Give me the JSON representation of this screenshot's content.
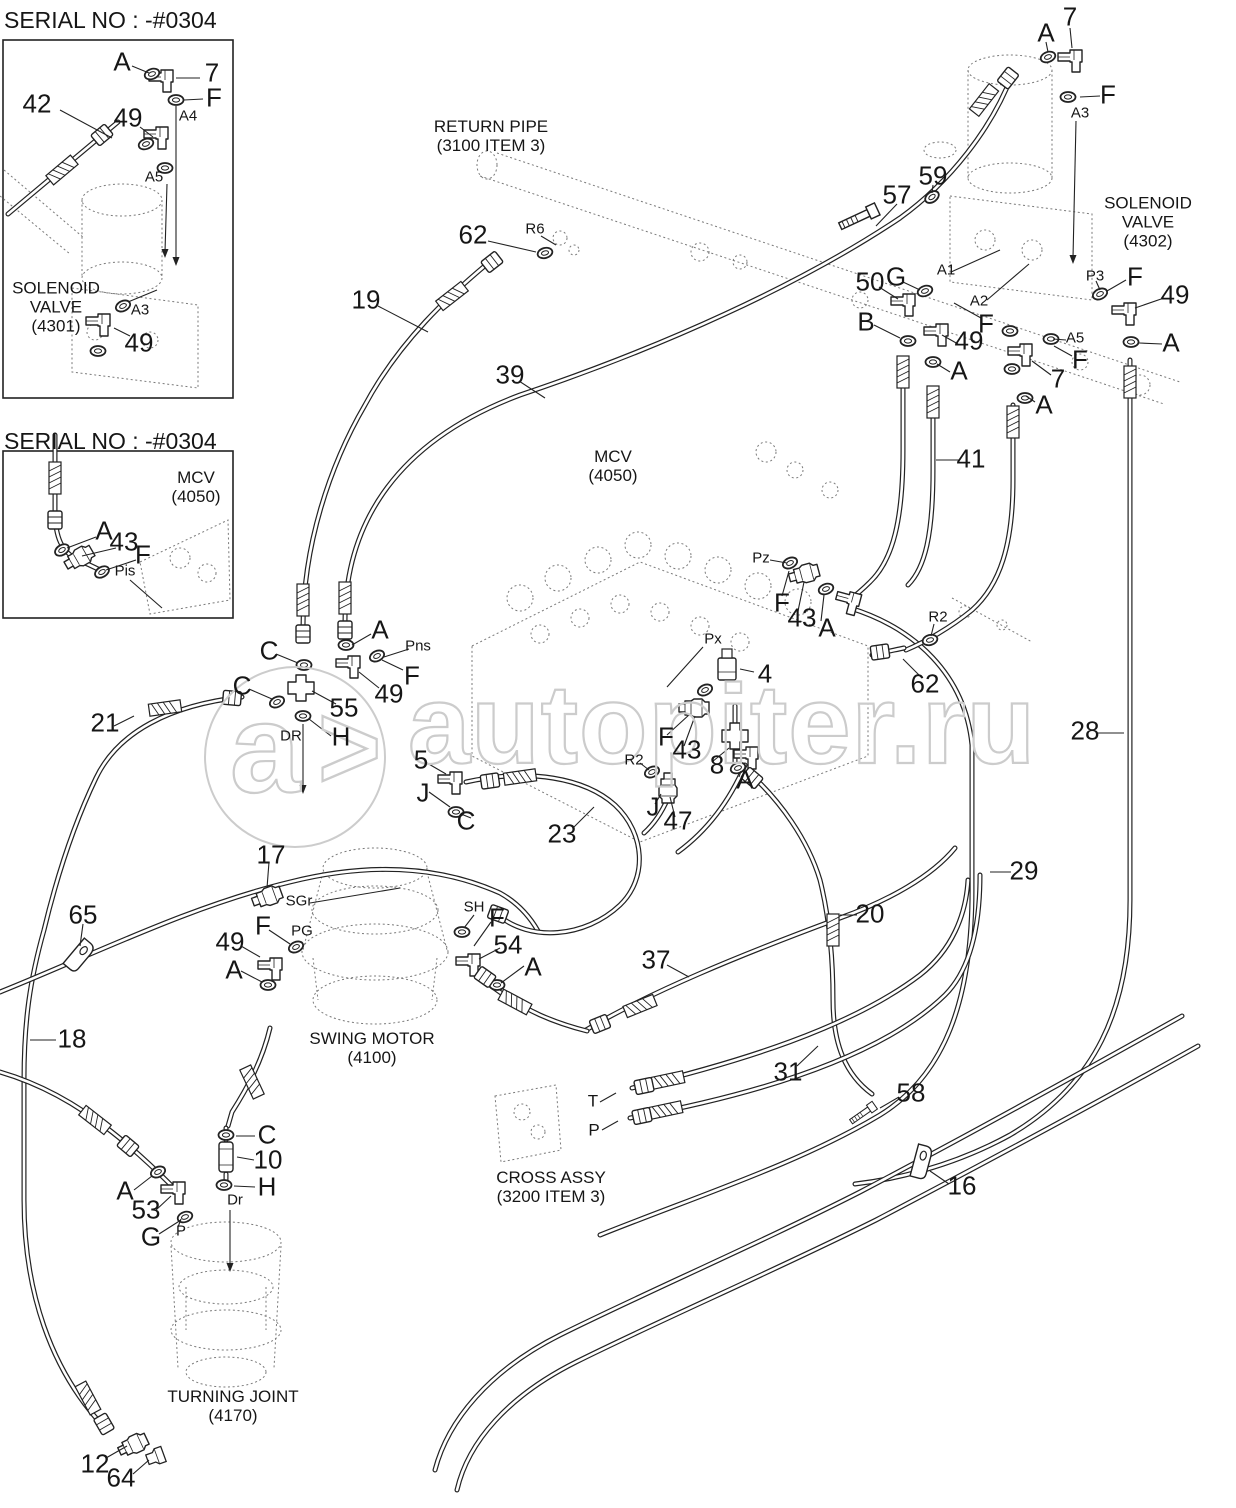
{
  "page": {
    "background": "#ffffff",
    "line_color": "#222222",
    "watermark_color": "#cccccc"
  },
  "watermark": {
    "text": "autopiter.ru",
    "logo_letter": "a",
    "logo_arrow": ">"
  },
  "diagram": {
    "labels": [
      {
        "t": "SERIAL NO : -#0304",
        "x": 4,
        "y": 8,
        "k": "t"
      },
      {
        "t": "A",
        "x": 122,
        "y": 62,
        "k": "l"
      },
      {
        "t": "7",
        "x": 212,
        "y": 73,
        "k": "n"
      },
      {
        "t": "F",
        "x": 214,
        "y": 98,
        "k": "l"
      },
      {
        "t": "A4",
        "x": 188,
        "y": 117,
        "k": "p"
      },
      {
        "t": "42",
        "x": 37,
        "y": 104,
        "k": "n"
      },
      {
        "t": "49",
        "x": 128,
        "y": 118,
        "k": "n"
      },
      {
        "t": "A5",
        "x": 154,
        "y": 178,
        "k": "p"
      },
      {
        "t": "SOLENOID\nVALVE\n(4301)",
        "x": 56,
        "y": 307,
        "k": "c"
      },
      {
        "t": "A3",
        "x": 140,
        "y": 311,
        "k": "p"
      },
      {
        "t": "49",
        "x": 139,
        "y": 343,
        "k": "n"
      },
      {
        "t": "SERIAL NO : -#0304",
        "x": 4,
        "y": 429,
        "k": "t"
      },
      {
        "t": "MCV\n(4050)",
        "x": 196,
        "y": 487,
        "k": "c"
      },
      {
        "t": "A",
        "x": 104,
        "y": 531,
        "k": "l"
      },
      {
        "t": "43",
        "x": 124,
        "y": 542,
        "k": "n"
      },
      {
        "t": "F",
        "x": 143,
        "y": 555,
        "k": "l"
      },
      {
        "t": "Pis",
        "x": 125,
        "y": 572,
        "k": "p"
      },
      {
        "t": "RETURN PIPE\n(3100 ITEM 3)",
        "x": 491,
        "y": 136,
        "k": "c"
      },
      {
        "t": "62",
        "x": 473,
        "y": 235,
        "k": "n"
      },
      {
        "t": "R6",
        "x": 535,
        "y": 230,
        "k": "p"
      },
      {
        "t": "19",
        "x": 366,
        "y": 300,
        "k": "n"
      },
      {
        "t": "39",
        "x": 510,
        "y": 375,
        "k": "n"
      },
      {
        "t": "A",
        "x": 1046,
        "y": 33,
        "k": "l"
      },
      {
        "t": "7",
        "x": 1070,
        "y": 17,
        "k": "n"
      },
      {
        "t": "F",
        "x": 1108,
        "y": 95,
        "k": "l"
      },
      {
        "t": "A3",
        "x": 1080,
        "y": 114,
        "k": "p"
      },
      {
        "t": "SOLENOID VALVE\n(4302)",
        "x": 1148,
        "y": 222,
        "k": "c"
      },
      {
        "t": "57",
        "x": 897,
        "y": 195,
        "k": "n"
      },
      {
        "t": "59",
        "x": 933,
        "y": 176,
        "k": "n"
      },
      {
        "t": "50",
        "x": 870,
        "y": 282,
        "k": "n"
      },
      {
        "t": "G",
        "x": 896,
        "y": 277,
        "k": "l"
      },
      {
        "t": "A1",
        "x": 946,
        "y": 271,
        "k": "p"
      },
      {
        "t": "A2",
        "x": 979,
        "y": 302,
        "k": "p"
      },
      {
        "t": "F",
        "x": 986,
        "y": 324,
        "k": "l"
      },
      {
        "t": "B",
        "x": 866,
        "y": 322,
        "k": "l"
      },
      {
        "t": "49",
        "x": 969,
        "y": 341,
        "k": "n"
      },
      {
        "t": "A",
        "x": 959,
        "y": 371,
        "k": "l"
      },
      {
        "t": "P3",
        "x": 1095,
        "y": 277,
        "k": "p"
      },
      {
        "t": "F",
        "x": 1135,
        "y": 277,
        "k": "l"
      },
      {
        "t": "49",
        "x": 1175,
        "y": 295,
        "k": "n"
      },
      {
        "t": "A",
        "x": 1171,
        "y": 343,
        "k": "l"
      },
      {
        "t": "A5",
        "x": 1075,
        "y": 339,
        "k": "p"
      },
      {
        "t": "F",
        "x": 1080,
        "y": 360,
        "k": "l"
      },
      {
        "t": "7",
        "x": 1058,
        "y": 379,
        "k": "n"
      },
      {
        "t": "A",
        "x": 1044,
        "y": 405,
        "k": "l"
      },
      {
        "t": "41",
        "x": 971,
        "y": 459,
        "k": "n"
      },
      {
        "t": "MCV\n(4050)",
        "x": 613,
        "y": 466,
        "k": "c"
      },
      {
        "t": "Pz",
        "x": 761,
        "y": 559,
        "k": "p"
      },
      {
        "t": "F",
        "x": 782,
        "y": 603,
        "k": "l"
      },
      {
        "t": "43",
        "x": 802,
        "y": 618,
        "k": "n"
      },
      {
        "t": "A",
        "x": 827,
        "y": 628,
        "k": "l"
      },
      {
        "t": "R2",
        "x": 938,
        "y": 618,
        "k": "p"
      },
      {
        "t": "62",
        "x": 925,
        "y": 684,
        "k": "n"
      },
      {
        "t": "Px",
        "x": 713,
        "y": 640,
        "k": "p"
      },
      {
        "t": "4",
        "x": 765,
        "y": 674,
        "k": "n"
      },
      {
        "t": "Pns",
        "x": 418,
        "y": 647,
        "k": "p"
      },
      {
        "t": "F",
        "x": 412,
        "y": 676,
        "k": "l"
      },
      {
        "t": "A",
        "x": 380,
        "y": 630,
        "k": "l"
      },
      {
        "t": "49",
        "x": 389,
        "y": 694,
        "k": "n"
      },
      {
        "t": "C",
        "x": 269,
        "y": 651,
        "k": "l"
      },
      {
        "t": "C",
        "x": 242,
        "y": 686,
        "k": "l"
      },
      {
        "t": "55",
        "x": 344,
        "y": 708,
        "k": "n"
      },
      {
        "t": "DR",
        "x": 291,
        "y": 737,
        "k": "p"
      },
      {
        "t": "H",
        "x": 341,
        "y": 737,
        "k": "l"
      },
      {
        "t": "21",
        "x": 105,
        "y": 723,
        "k": "n"
      },
      {
        "t": "5",
        "x": 421,
        "y": 760,
        "k": "n"
      },
      {
        "t": "J",
        "x": 423,
        "y": 793,
        "k": "l"
      },
      {
        "t": "C",
        "x": 466,
        "y": 821,
        "k": "l"
      },
      {
        "t": "23",
        "x": 562,
        "y": 834,
        "k": "n"
      },
      {
        "t": "8",
        "x": 717,
        "y": 765,
        "k": "n"
      },
      {
        "t": "A",
        "x": 745,
        "y": 780,
        "k": "l"
      },
      {
        "t": "F",
        "x": 666,
        "y": 737,
        "k": "l"
      },
      {
        "t": "43",
        "x": 687,
        "y": 750,
        "k": "n"
      },
      {
        "t": "R2",
        "x": 634,
        "y": 761,
        "k": "p"
      },
      {
        "t": "J",
        "x": 653,
        "y": 807,
        "k": "l"
      },
      {
        "t": "47",
        "x": 678,
        "y": 821,
        "k": "n"
      },
      {
        "t": "28",
        "x": 1085,
        "y": 731,
        "k": "n"
      },
      {
        "t": "29",
        "x": 1024,
        "y": 871,
        "k": "n"
      },
      {
        "t": "20",
        "x": 870,
        "y": 914,
        "k": "n"
      },
      {
        "t": "37",
        "x": 656,
        "y": 960,
        "k": "n"
      },
      {
        "t": "17",
        "x": 271,
        "y": 855,
        "k": "n"
      },
      {
        "t": "SGr",
        "x": 299,
        "y": 902,
        "k": "p"
      },
      {
        "t": "F",
        "x": 263,
        "y": 926,
        "k": "l"
      },
      {
        "t": "PG",
        "x": 302,
        "y": 932,
        "k": "p"
      },
      {
        "t": "49",
        "x": 230,
        "y": 942,
        "k": "n"
      },
      {
        "t": "A",
        "x": 234,
        "y": 970,
        "k": "l"
      },
      {
        "t": "SH",
        "x": 474,
        "y": 908,
        "k": "p"
      },
      {
        "t": "F",
        "x": 497,
        "y": 918,
        "k": "l"
      },
      {
        "t": "54",
        "x": 508,
        "y": 945,
        "k": "n"
      },
      {
        "t": "A",
        "x": 533,
        "y": 967,
        "k": "l"
      },
      {
        "t": "SWING MOTOR\n(4100)",
        "x": 372,
        "y": 1048,
        "k": "c"
      },
      {
        "t": "65",
        "x": 83,
        "y": 915,
        "k": "n"
      },
      {
        "t": "18",
        "x": 72,
        "y": 1039,
        "k": "n"
      },
      {
        "t": "31",
        "x": 788,
        "y": 1072,
        "k": "n"
      },
      {
        "t": "T",
        "x": 593,
        "y": 1101,
        "k": "q"
      },
      {
        "t": "P",
        "x": 594,
        "y": 1130,
        "k": "q"
      },
      {
        "t": "CROSS ASSY\n(3200 ITEM 3)",
        "x": 551,
        "y": 1187,
        "k": "c"
      },
      {
        "t": "58",
        "x": 911,
        "y": 1093,
        "k": "n"
      },
      {
        "t": "16",
        "x": 962,
        "y": 1186,
        "k": "n"
      },
      {
        "t": "C",
        "x": 267,
        "y": 1135,
        "k": "l"
      },
      {
        "t": "10",
        "x": 268,
        "y": 1160,
        "k": "n"
      },
      {
        "t": "H",
        "x": 267,
        "y": 1187,
        "k": "l"
      },
      {
        "t": "Dr",
        "x": 235,
        "y": 1201,
        "k": "p"
      },
      {
        "t": "A",
        "x": 125,
        "y": 1191,
        "k": "l"
      },
      {
        "t": "53",
        "x": 146,
        "y": 1210,
        "k": "n"
      },
      {
        "t": "G",
        "x": 151,
        "y": 1237,
        "k": "l"
      },
      {
        "t": "P",
        "x": 181,
        "y": 1232,
        "k": "p"
      },
      {
        "t": "TURNING JOINT\n(4170)",
        "x": 233,
        "y": 1406,
        "k": "c"
      },
      {
        "t": "12",
        "x": 95,
        "y": 1464,
        "k": "n"
      },
      {
        "t": "64",
        "x": 121,
        "y": 1478,
        "k": "n"
      }
    ]
  }
}
